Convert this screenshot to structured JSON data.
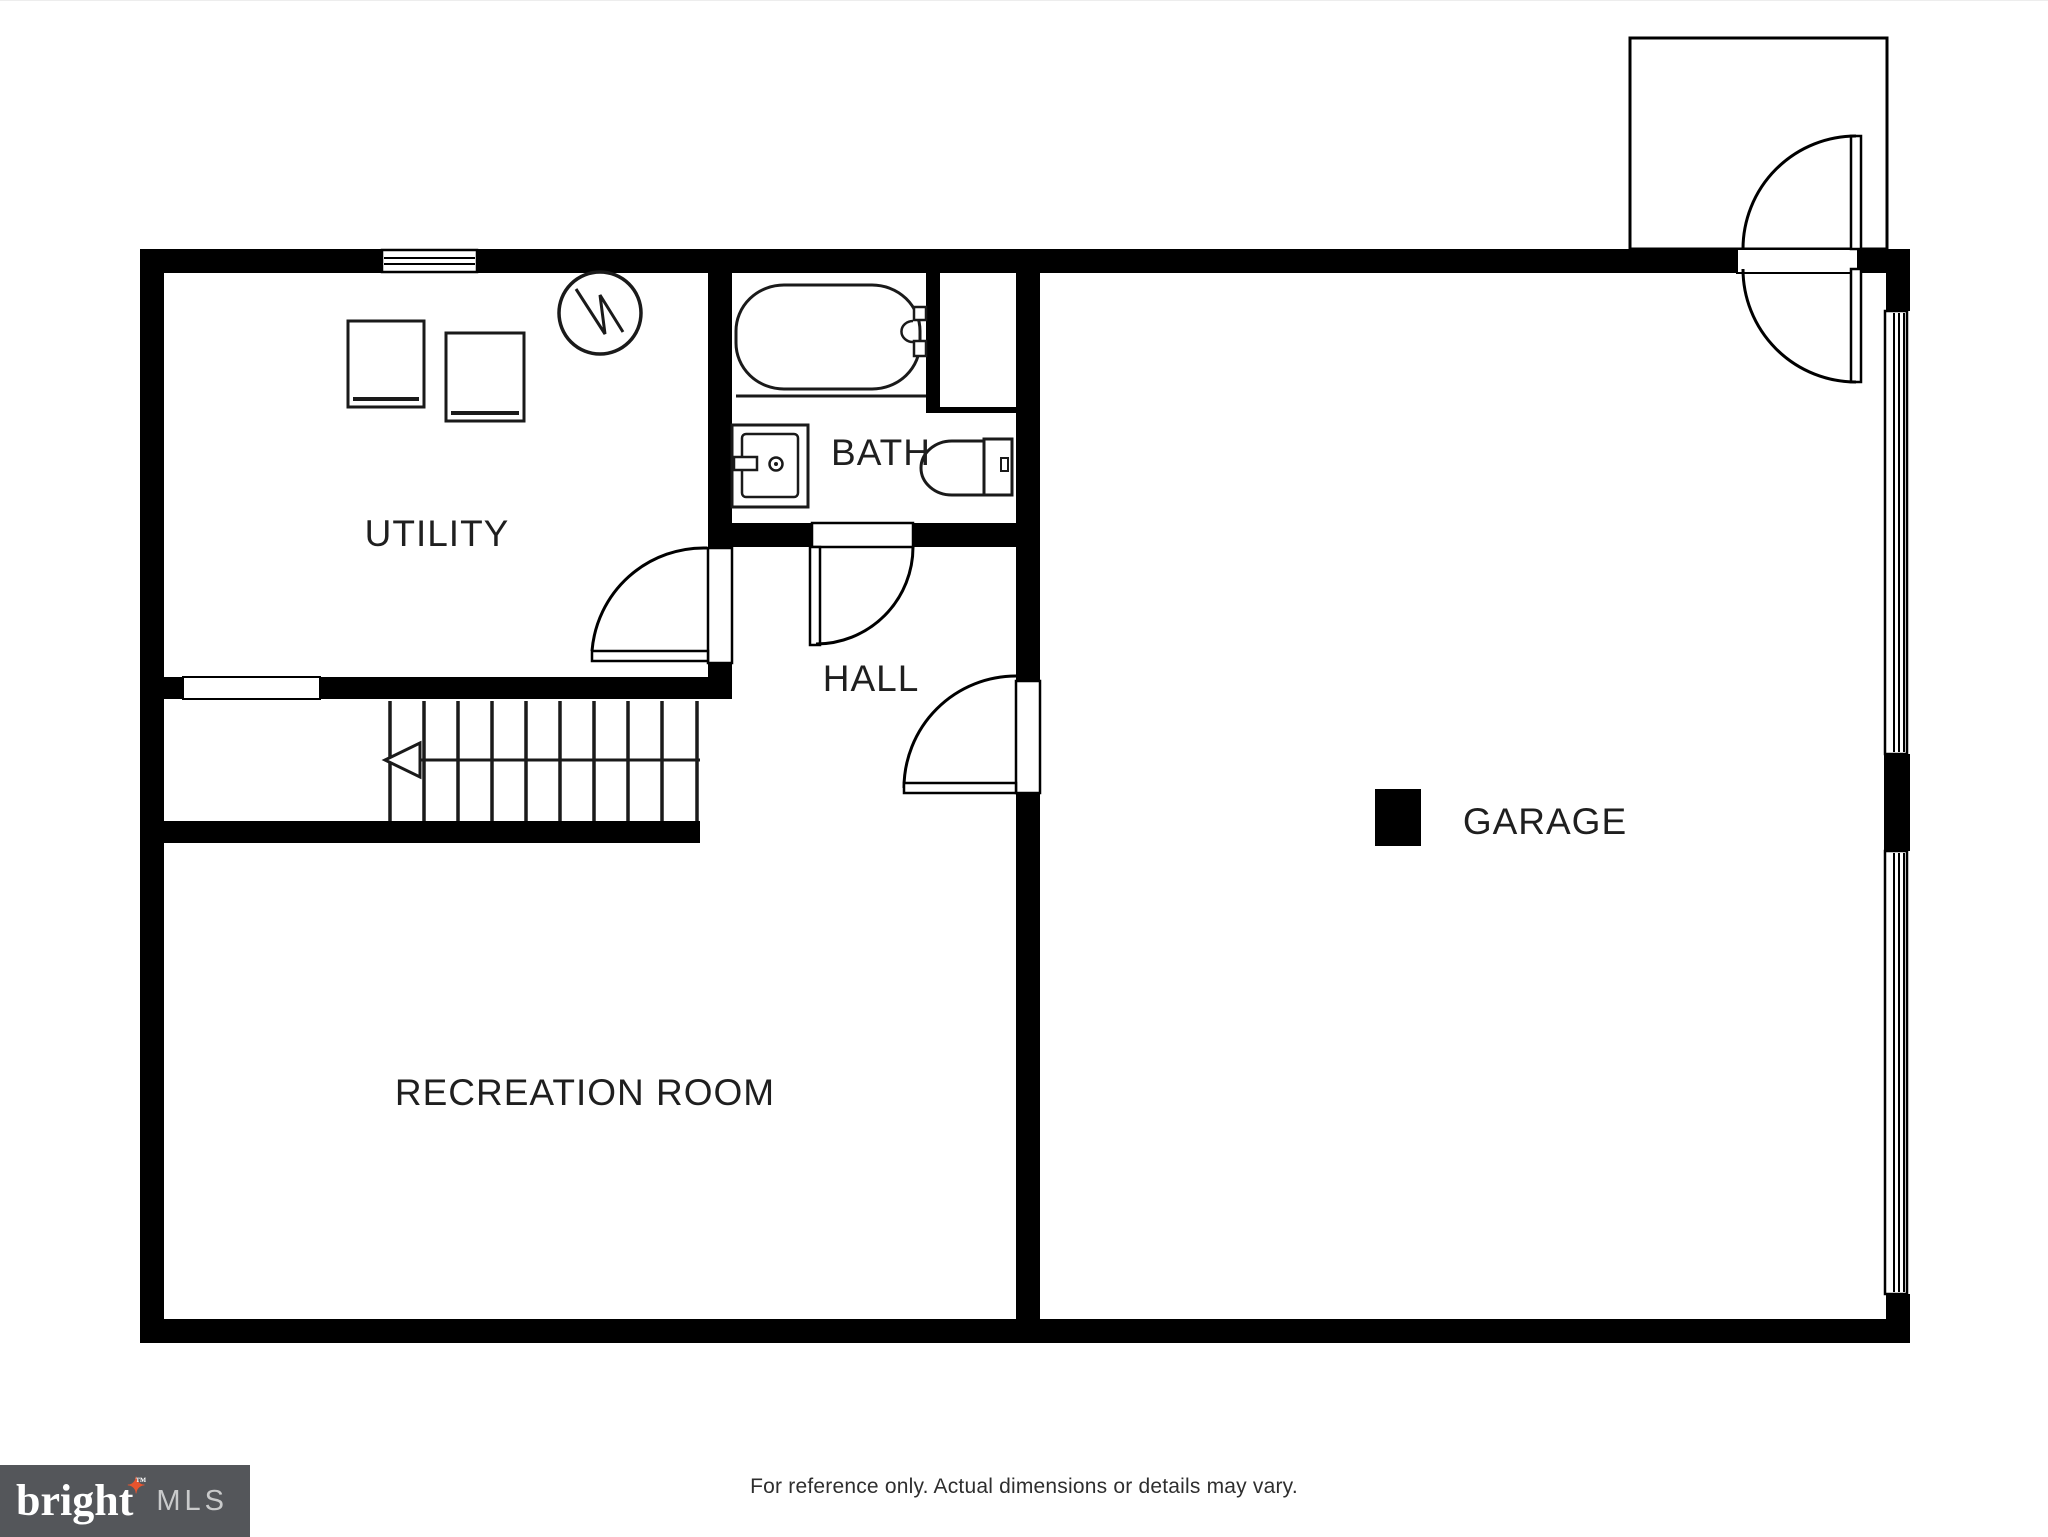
{
  "page": {
    "background": "#ffffff"
  },
  "floor_plan": {
    "wall_color": "#000000",
    "line_color": "#1f1f1f",
    "rooms": [
      {
        "id": "utility",
        "label": "UTILITY"
      },
      {
        "id": "bath",
        "label": "BATH"
      },
      {
        "id": "hall",
        "label": "HALL"
      },
      {
        "id": "garage",
        "label": "GARAGE"
      },
      {
        "id": "recreation",
        "label": "RECREATION ROOM"
      }
    ],
    "fixtures": [
      {
        "name": "washer"
      },
      {
        "name": "dryer"
      },
      {
        "name": "water-heater"
      },
      {
        "name": "bathtub"
      },
      {
        "name": "sink"
      },
      {
        "name": "toilet"
      },
      {
        "name": "stairs"
      },
      {
        "name": "support-column"
      },
      {
        "name": "entry-stoop"
      }
    ]
  },
  "footer": {
    "disclaimer": "For reference only. Actual dimensions or details may vary."
  },
  "logo": {
    "brand": "bright",
    "trademark": "™",
    "suffix": "MLS",
    "star": "✦",
    "background": "#54565a",
    "star_color": "#e8542e",
    "brand_color": "#ffffff",
    "suffix_color": "#c9cacb"
  }
}
